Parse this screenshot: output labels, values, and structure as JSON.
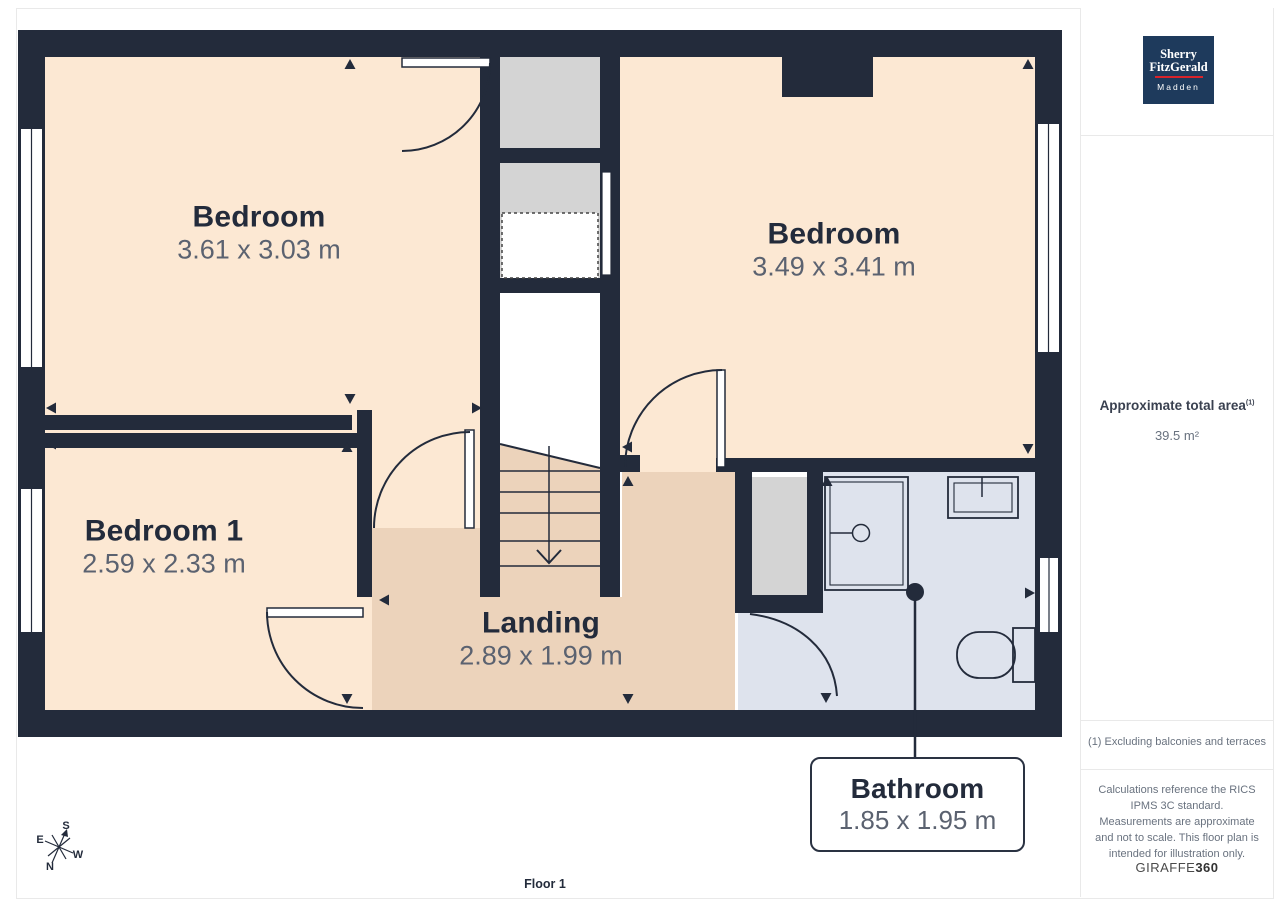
{
  "plan": {
    "floor_label": "Floor 1",
    "rooms": [
      {
        "id": "bedroom-left",
        "name": "Bedroom",
        "dims": "3.61 x 3.03 m"
      },
      {
        "id": "bedroom-right",
        "name": "Bedroom",
        "dims": "3.49 x 3.41 m"
      },
      {
        "id": "bedroom-1",
        "name": "Bedroom 1",
        "dims": "2.59 x 2.33 m"
      },
      {
        "id": "landing",
        "name": "Landing",
        "dims": "2.89 x 1.99 m"
      },
      {
        "id": "bathroom",
        "name": "Bathroom",
        "dims": "1.85 x 1.95 m"
      }
    ],
    "compass": {
      "n": "N",
      "s": "S",
      "e": "E",
      "w": "W"
    }
  },
  "sidebar": {
    "logo": {
      "line1": "Sherry",
      "line2": "FitzGerald",
      "line3": "Madden"
    },
    "total_area_label": "Approximate total area",
    "total_area_superscript": "(1)",
    "total_area_value": "39.5 m²",
    "footnote": "(1) Excluding balconies and terraces",
    "disclaimer": "Calculations reference the RICS IPMS 3C standard. Measurements are approximate and not to scale. This floor plan is intended for illustration only.",
    "brand": "GIRAFFE",
    "brand_suffix": "360"
  },
  "colors": {
    "wall": "#232B3B",
    "room_fill": "#FCE8D3",
    "landing_fill": "#ECD3BB",
    "bathroom_fill": "#DEE3ED",
    "closet_fill": "#D4D4D4",
    "logo_bg": "#1E3A5C",
    "logo_accent": "#D9232A"
  }
}
